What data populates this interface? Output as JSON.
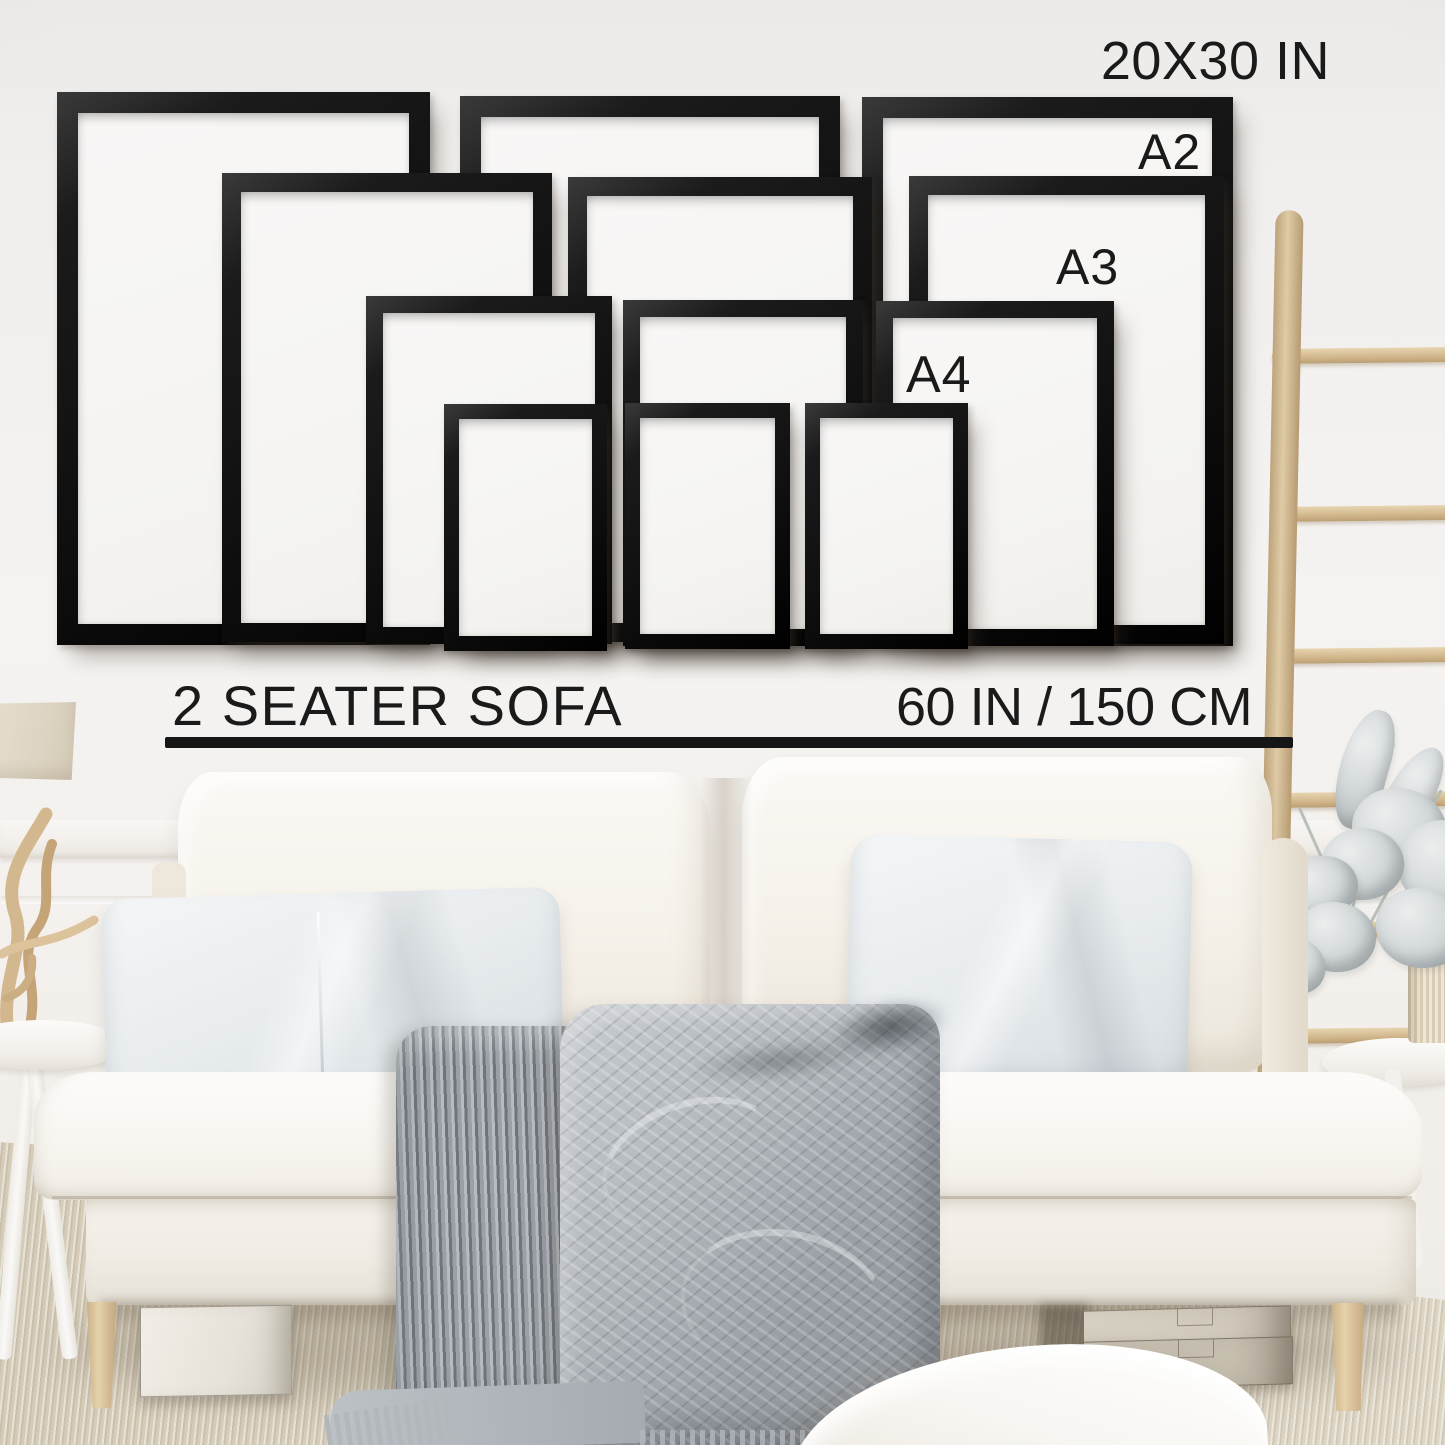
{
  "size_guide": {
    "frame_size_label": "20X30 IN",
    "a2_label": "A2",
    "a3_label": "A3",
    "a4_label": "A4",
    "frames": [
      {
        "size": "20x30 in",
        "position": "back-left"
      },
      {
        "size": "20x30 in",
        "position": "back-center"
      },
      {
        "size": "20x30 in",
        "position": "back-right"
      },
      {
        "size": "A2",
        "position": "mid-left"
      },
      {
        "size": "A2",
        "position": "mid-center"
      },
      {
        "size": "A2",
        "position": "mid-right"
      },
      {
        "size": "A3",
        "position": "front-left"
      },
      {
        "size": "A3",
        "position": "front-center"
      },
      {
        "size": "A3",
        "position": "front-right"
      },
      {
        "size": "A4",
        "position": "frontmost-left"
      },
      {
        "size": "A4",
        "position": "frontmost-center"
      },
      {
        "size": "A4",
        "position": "frontmost-right"
      }
    ]
  },
  "scale_reference": {
    "sofa_type": "2 SEATER SOFA",
    "sofa_width": "60 IN / 150 CM"
  },
  "scene_items": [
    "table-lamp",
    "driftwood-sculpture",
    "side-table-left",
    "sofa",
    "back-cushion-left",
    "back-cushion-right",
    "lumbar-pillow",
    "square-pillow",
    "knit-throw-blanket",
    "storage-box-left",
    "stacked-boxes-right",
    "floor-cushion",
    "wooden-ladder",
    "eucalyptus-plant",
    "fluted-vase",
    "side-table-right",
    "carpet-floor"
  ],
  "colors": {
    "frame_black": "#141414",
    "text": "#1a1a1a",
    "wall": "#f2f0ee",
    "sofa_fabric": "#f7f4ef",
    "pillow_gray_white": "#e8ecef",
    "blanket_gray": "#9aa0a6",
    "wood_light": "#d9c29c",
    "floor_carpet": "#d8cfbd"
  }
}
